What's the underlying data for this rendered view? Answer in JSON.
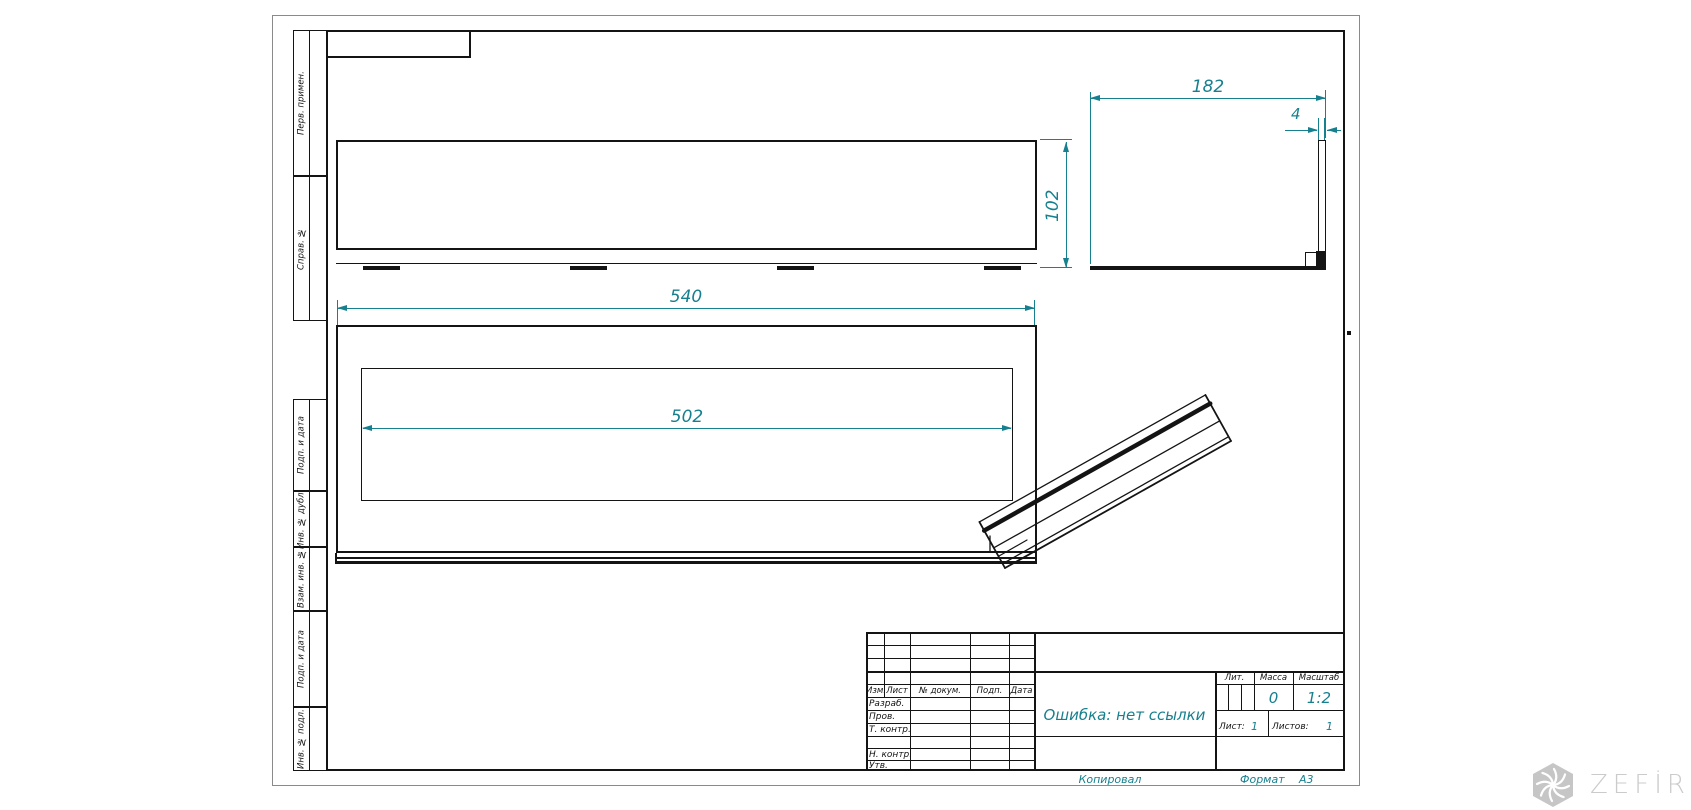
{
  "drawing": {
    "doc_name": "Ошибка: нет ссылки",
    "copied_label": "Копировал",
    "format_label": "Формат",
    "format_value": "А3"
  },
  "left_strip": {
    "items": [
      "Перв. примен.",
      "Справ. №",
      "Подп. и дата",
      "Инв. № дубл.",
      "Взам. инв. №",
      "Подп. и дата",
      "Инв. № подл."
    ]
  },
  "title_block": {
    "header_cols": [
      "Изм.",
      "Лист",
      "№ докум.",
      "Подп.",
      "Дата"
    ],
    "rows": [
      "Разраб.",
      "Пров.",
      "Т. контр.",
      "Н. контр.",
      "Утв."
    ],
    "lit_label": "Лит.",
    "massa_label": "Масса",
    "masshtab_label": "Масштаб",
    "massa_value": "0",
    "masshtab_value": "1:2",
    "list_label": "Лист:",
    "list_value": "1",
    "listov_label": "Листов:",
    "listov_value": "1"
  },
  "dimensions": {
    "length": "540",
    "opening": "502",
    "height": "102",
    "depth": "182",
    "thickness": "4"
  },
  "watermark": {
    "brand": "ZEFİRE"
  },
  "colors": {
    "dim_teal": "#17808e",
    "line": "#141414",
    "logo_gray": "#c7c7c7"
  }
}
